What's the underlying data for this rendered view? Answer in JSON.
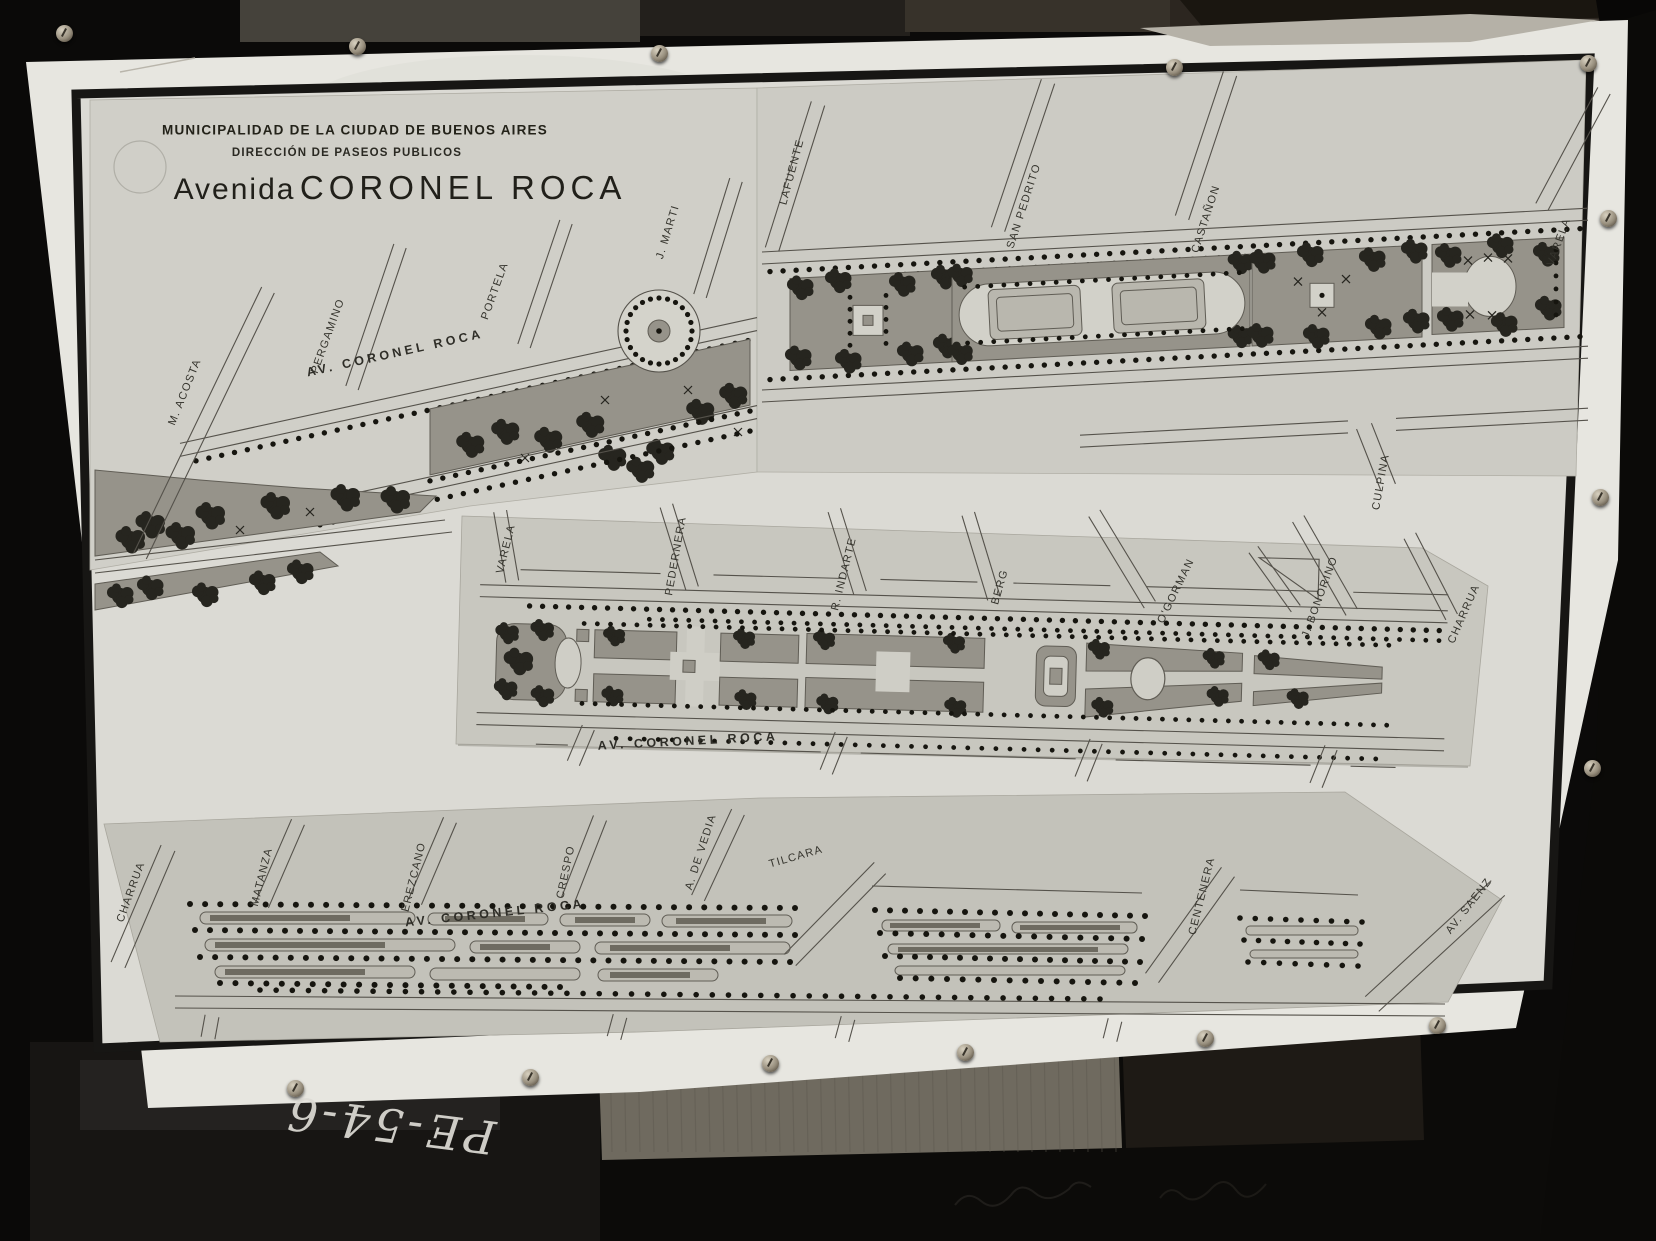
{
  "title_block": {
    "line1": "MUNICIPALIDAD DE LA CIUDAD DE BUENOS AIRES",
    "line2": "DIRECCIÓN DE PASEOS PUBLICOS",
    "title_prefix": "Avenida",
    "title_main": "CORONEL ROCA"
  },
  "strips": [
    {
      "id": "upper-strip",
      "avenue_label": {
        "text": "AV. CORONEL ROCA",
        "x": 395,
        "y": 353,
        "angle": -12.5
      },
      "streets": [
        {
          "name": "M. ACOSTA",
          "x": 185,
          "y": 392,
          "angle": -68
        },
        {
          "name": "PERGAMINO",
          "x": 328,
          "y": 336,
          "angle": -70
        },
        {
          "name": "PORTELA",
          "x": 495,
          "y": 291,
          "angle": -70
        },
        {
          "name": "J. MARTI",
          "x": 668,
          "y": 232,
          "angle": -73
        },
        {
          "name": "LAFUENTE",
          "x": 792,
          "y": 172,
          "angle": -75
        },
        {
          "name": "SAN PEDRITO",
          "x": 1024,
          "y": 206,
          "angle": -72
        },
        {
          "name": "CASTAÑON",
          "x": 1206,
          "y": 219,
          "angle": -72
        },
        {
          "name": "VARELA",
          "x": 1559,
          "y": 242,
          "angle": -70
        },
        {
          "name": "CULPINA",
          "x": 1381,
          "y": 482,
          "angle": -80
        }
      ]
    },
    {
      "id": "middle-strip",
      "avenue_label": {
        "text": "AV. CORONEL ROCA",
        "x": 688,
        "y": 741,
        "angle": -3
      },
      "streets": [
        {
          "name": "VARELA",
          "x": 506,
          "y": 549,
          "angle": -76
        },
        {
          "name": "PEDERNERA",
          "x": 676,
          "y": 556,
          "angle": -80
        },
        {
          "name": "R. INDARTE",
          "x": 844,
          "y": 574,
          "angle": -76
        },
        {
          "name": "BERG",
          "x": 1000,
          "y": 587,
          "angle": -74
        },
        {
          "name": "O'GORMAN",
          "x": 1176,
          "y": 591,
          "angle": -64
        },
        {
          "name": "J. BONORINO",
          "x": 1320,
          "y": 597,
          "angle": -70
        },
        {
          "name": "CHARRUA",
          "x": 1464,
          "y": 614,
          "angle": -66
        }
      ]
    },
    {
      "id": "lower-strip",
      "avenue_label": {
        "text": "AV. CORONEL ROCA",
        "x": 495,
        "y": 913,
        "angle": -6
      },
      "streets": [
        {
          "name": "CHARRUA",
          "x": 131,
          "y": 892,
          "angle": -70
        },
        {
          "name": "MATANZA",
          "x": 262,
          "y": 877,
          "angle": -76
        },
        {
          "name": "EREZCANO",
          "x": 414,
          "y": 877,
          "angle": -76
        },
        {
          "name": "CRESPO",
          "x": 566,
          "y": 872,
          "angle": -78
        },
        {
          "name": "A. DE VEDIA",
          "x": 701,
          "y": 852,
          "angle": -72
        },
        {
          "name": "TILCARA",
          "x": 796,
          "y": 857,
          "angle": -16
        },
        {
          "name": "CENTENERA",
          "x": 1202,
          "y": 896,
          "angle": -76
        },
        {
          "name": "AV. SAENZ",
          "x": 1469,
          "y": 906,
          "angle": -52
        }
      ]
    }
  ],
  "handwritten_note": "PE-54-6",
  "colors": {
    "background": "#0b0a09",
    "poster": "#e7e6e0",
    "frame": "#171614",
    "paper": "#cccbc3",
    "park": "#96938a",
    "road_line": "#55524b",
    "tree": "#26251f",
    "dot": "#16150f",
    "ink": "#232219",
    "note": "#dedcd6"
  },
  "icons": {
    "tack": "push-pin-icon"
  }
}
